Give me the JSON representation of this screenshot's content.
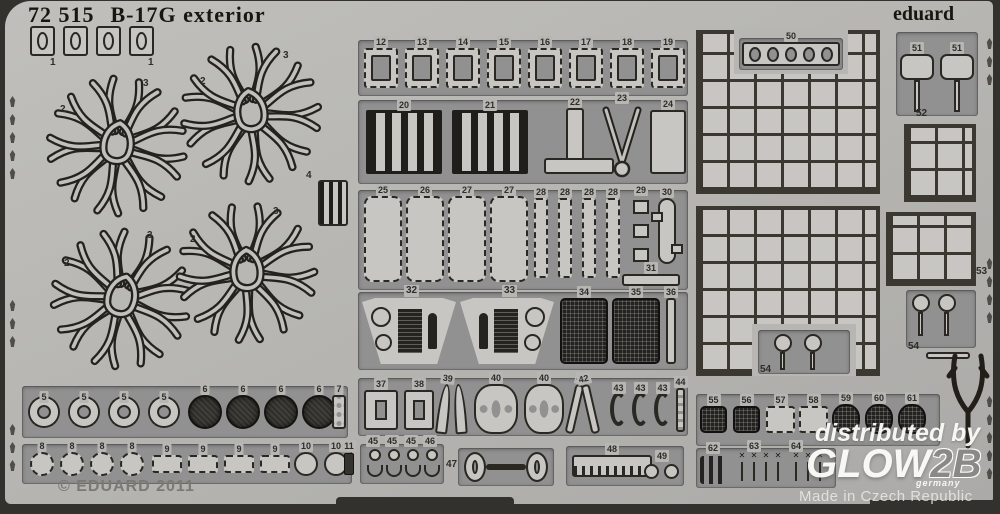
{
  "header": {
    "sku": "72 515",
    "title": "B-17G exterior",
    "brand": "eduard"
  },
  "footer": {
    "copyright": "© EDUARD 2011",
    "made_in": "Made in Czech Republic"
  },
  "watermark": {
    "prefix": "distributed by",
    "brand": "GLOW",
    "brand_suffix": "2B",
    "country": "germany"
  },
  "colors": {
    "background": "#33312d",
    "fret": "#b7b6b2",
    "recess": "#929191",
    "part": "#c7c6c2",
    "outline": "#2a2823",
    "etched_number": "#2e2d29",
    "title_text": "#17160f",
    "copyright_text": "#7b7974",
    "watermark_text": "#f4f3f0"
  },
  "parts": {
    "clips": [
      "1",
      "1"
    ],
    "harness": {
      "left": "2",
      "right": "3"
    },
    "louver": "4",
    "rings": [
      "5",
      "5",
      "5",
      "5"
    ],
    "discs": [
      "6",
      "6",
      "6",
      "6"
    ],
    "plate": "7",
    "wheels": [
      "8",
      "8",
      "8",
      "8"
    ],
    "pads": [
      "9",
      "9",
      "9",
      "9"
    ],
    "hubs": [
      "10",
      "10"
    ],
    "hook": "11",
    "frames": [
      "12",
      "13",
      "14",
      "15",
      "16",
      "17",
      "18",
      "19"
    ],
    "ladders": [
      "20",
      "21"
    ],
    "bracket": "22",
    "fork": "23",
    "door": "24",
    "panels": [
      "25",
      "26",
      "27",
      "27"
    ],
    "strips": [
      "28",
      "28",
      "28",
      "28"
    ],
    "stack": "29",
    "cylinder": "30",
    "bar": "31",
    "instrument_panels": [
      "32",
      "33"
    ],
    "mesh_panels": [
      "34",
      "35"
    ],
    "spar": "36",
    "fittings": [
      "37",
      "38",
      "39",
      "40",
      "40",
      "41",
      "42",
      "43",
      "43",
      "43",
      "44"
    ],
    "anchors": [
      "45",
      "45",
      "45",
      "46"
    ],
    "dumbbell": "47",
    "comb": "48",
    "link": "49",
    "oval_strip": "50",
    "paddles": [
      "51",
      "51"
    ],
    "grille_small_top": "52",
    "grille_small_bottom": "53",
    "lollipops": [
      "54",
      "54"
    ],
    "right_row": [
      "55",
      "56",
      "57",
      "58",
      "59",
      "60",
      "61"
    ],
    "bottom_row": [
      "62",
      "63",
      "64"
    ]
  }
}
